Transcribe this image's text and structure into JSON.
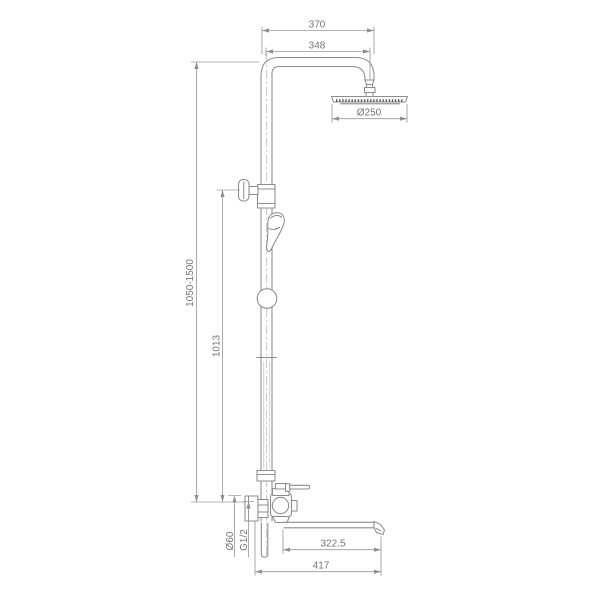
{
  "drawing": {
    "subject": "shower-column-technical-drawing",
    "colors": {
      "background": "#ffffff",
      "product_line": "#8c8c8c",
      "dimension_line": "#9c9c9c",
      "dimension_text": "#757575"
    },
    "dimensions": {
      "top_overall_width": "370",
      "arm_center_to_center": "348",
      "head_diameter": "Ø250",
      "height_adjustable_range": "1050-1500",
      "riser_height": "1013",
      "escutcheon_diameter": "Ø60",
      "connection_thread": "G1/2",
      "spout_reach": "322.5",
      "overall_reach": "417"
    }
  }
}
